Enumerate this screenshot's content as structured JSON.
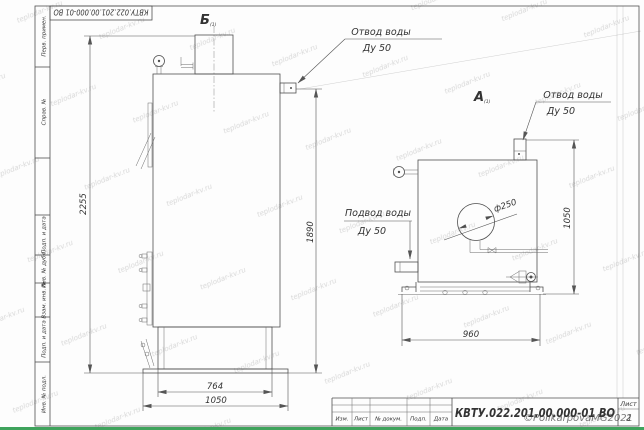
{
  "drawing": {
    "designation": "КВТУ.022.201.00.000-01 ВО",
    "corner_stamp": "КВТУ.022.201.00.000-01 ВО",
    "sheet_label": "Лист",
    "sheet_number": "2",
    "title_columns": [
      "Изм.",
      "Лист",
      "№ докум.",
      "Подп.",
      "Дата"
    ]
  },
  "side_strip": {
    "labels": [
      "Перв. примен.",
      "Справ. №",
      "Подп. и дата",
      "Инв. № дубл.",
      "Взам. инв. №",
      "Подп. и дата",
      "Инв. № подл."
    ]
  },
  "views": {
    "b": {
      "label": "Б",
      "sub": "(1)"
    },
    "a": {
      "label": "А",
      "sub": "(1)"
    }
  },
  "annotations": {
    "outlet_b": {
      "line1": "Отвод воды",
      "line2": "Ду 50"
    },
    "outlet_a": {
      "line1": "Отвод воды",
      "line2": "Ду 50"
    },
    "inlet_a": {
      "line1": "Подвод воды",
      "line2": "Ду 50"
    }
  },
  "dimensions": {
    "b_total_height": "2255",
    "b_outlet_height": "1890",
    "b_base_width": "764",
    "b_total_width": "1050",
    "a_outlet_height": "1050",
    "a_width": "960",
    "a_door_diameter": "ф250"
  },
  "watermarks": {
    "copyright": "©PolikarpovaMG2021",
    "tile": "teplodar-kv.ru"
  },
  "colors": {
    "bottom_bar": "#3fa35c",
    "copyright": "#8f6a6a"
  }
}
